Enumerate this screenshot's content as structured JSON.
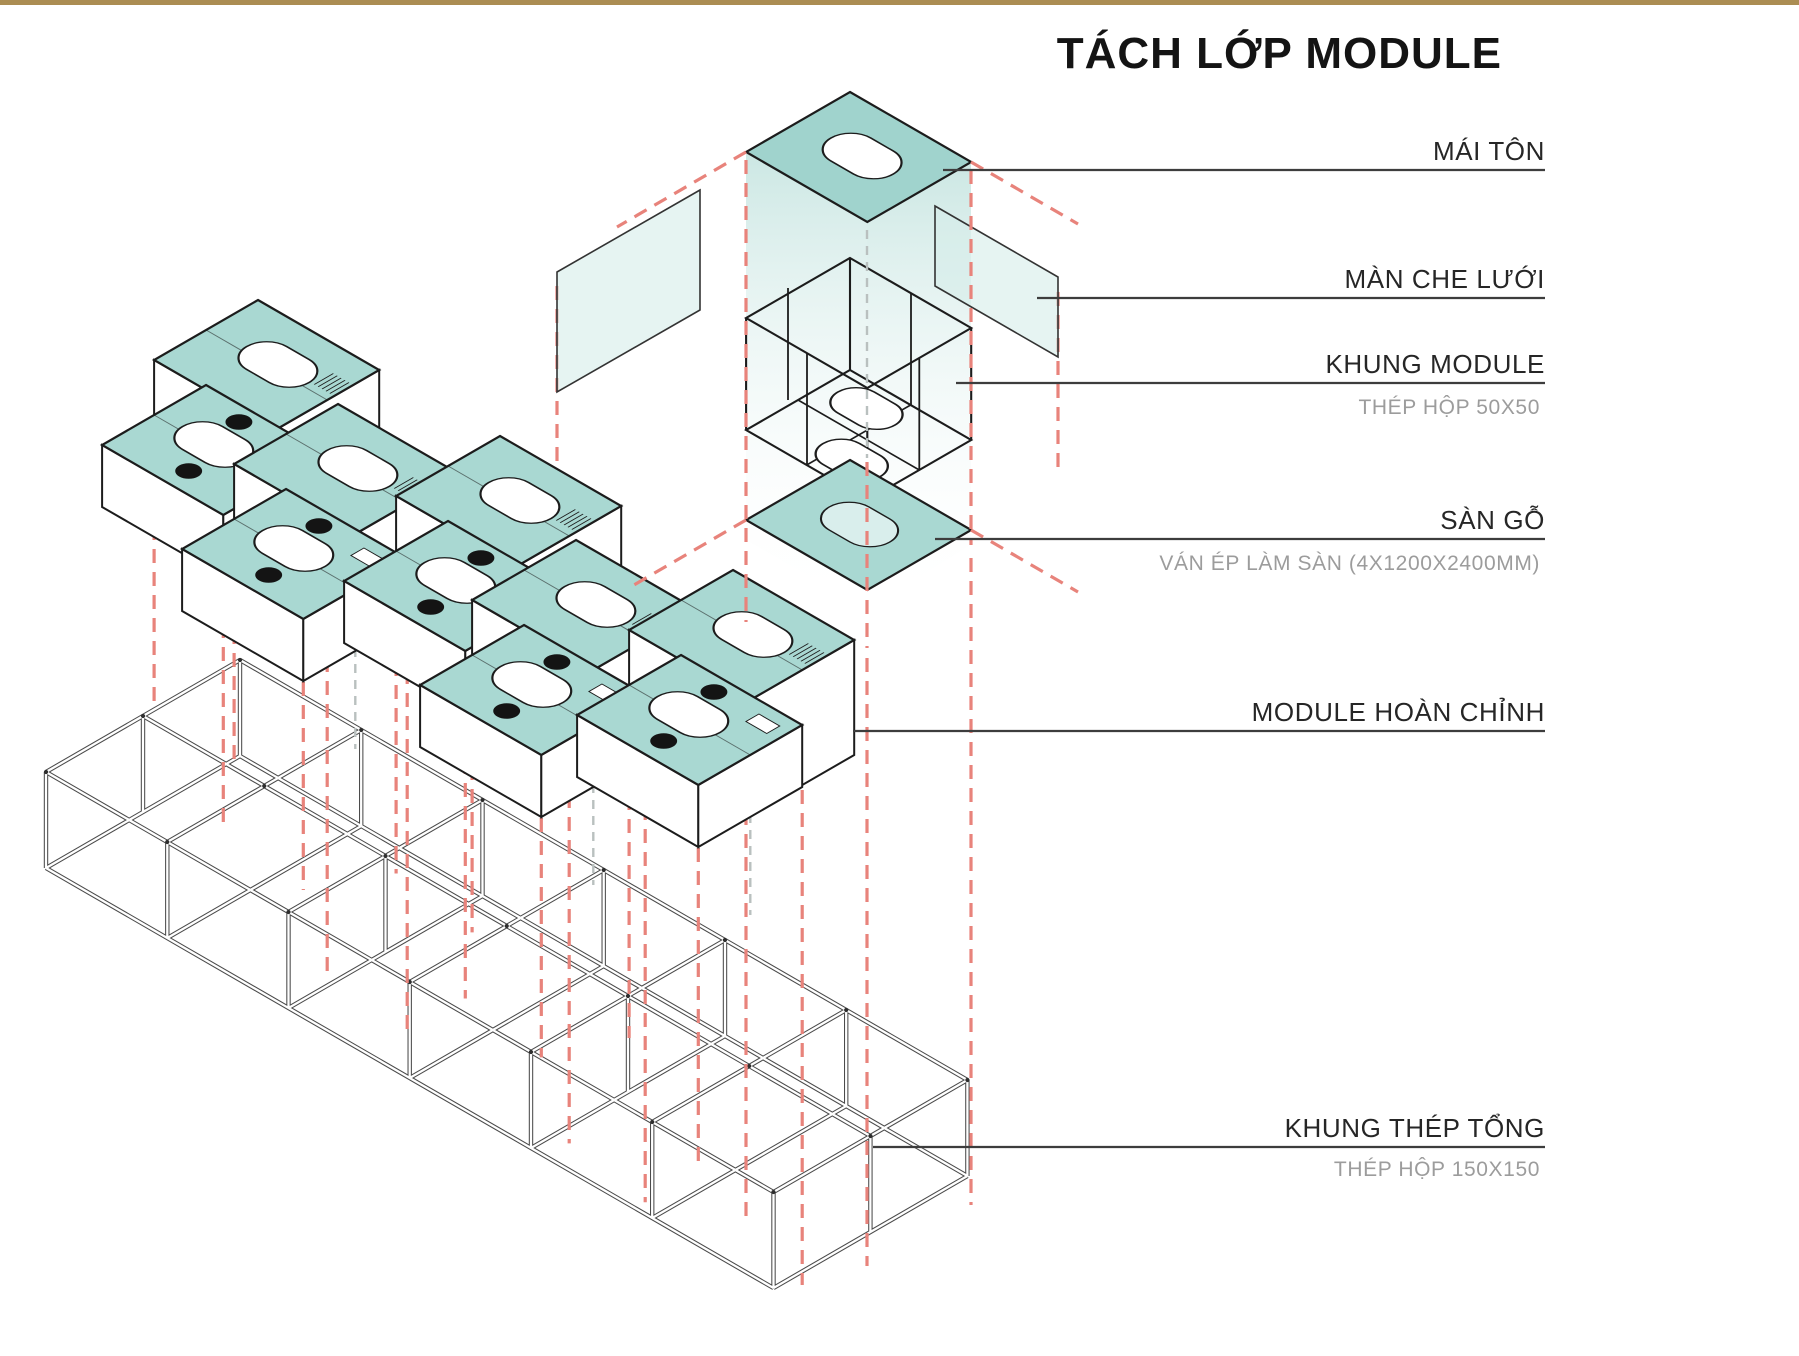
{
  "title": "TÁCH LỚP MODULE",
  "annotations": [
    {
      "id": "mai-ton",
      "label": "MÁI TÔN",
      "sub": ""
    },
    {
      "id": "man-che-luoi",
      "label": "MÀN CHE LƯỚI",
      "sub": ""
    },
    {
      "id": "khung-module",
      "label": "KHUNG MODULE",
      "sub": "THÉP HỘP 50X50"
    },
    {
      "id": "san-go",
      "label": "SÀN GỖ",
      "sub": "VÁN ÉP LÀM SÀN (4X1200X2400MM)"
    },
    {
      "id": "module-hoan-chinh",
      "label": "MODULE HOÀN CHỈNH",
      "sub": ""
    },
    {
      "id": "khung-thep-tong",
      "label": "KHUNG THÉP TỔNG",
      "sub": "THÉP HỘP 150X150"
    }
  ],
  "diagram": {
    "module_count": 5,
    "exploded_layers_top_to_bottom": [
      "MÁI TÔN",
      "MÀN CHE LƯỚI",
      "KHUNG MODULE",
      "SÀN GỖ"
    ]
  },
  "colors": {
    "accent_bar": "#ab8d53",
    "module_teal": "#a9d8d2",
    "roof_teal": "#a0d3cd",
    "floor_hole_teal": "#d9eeec",
    "glow_teal": "#c9e6e2",
    "screen_teal": "#d6ece9",
    "dash_red": "#e8837b",
    "dash_gray": "#b9c0bf",
    "line_dark": "#1c1c1c",
    "frame_gray": "#4b4b4b",
    "label_gray": "#9c9c9c"
  }
}
